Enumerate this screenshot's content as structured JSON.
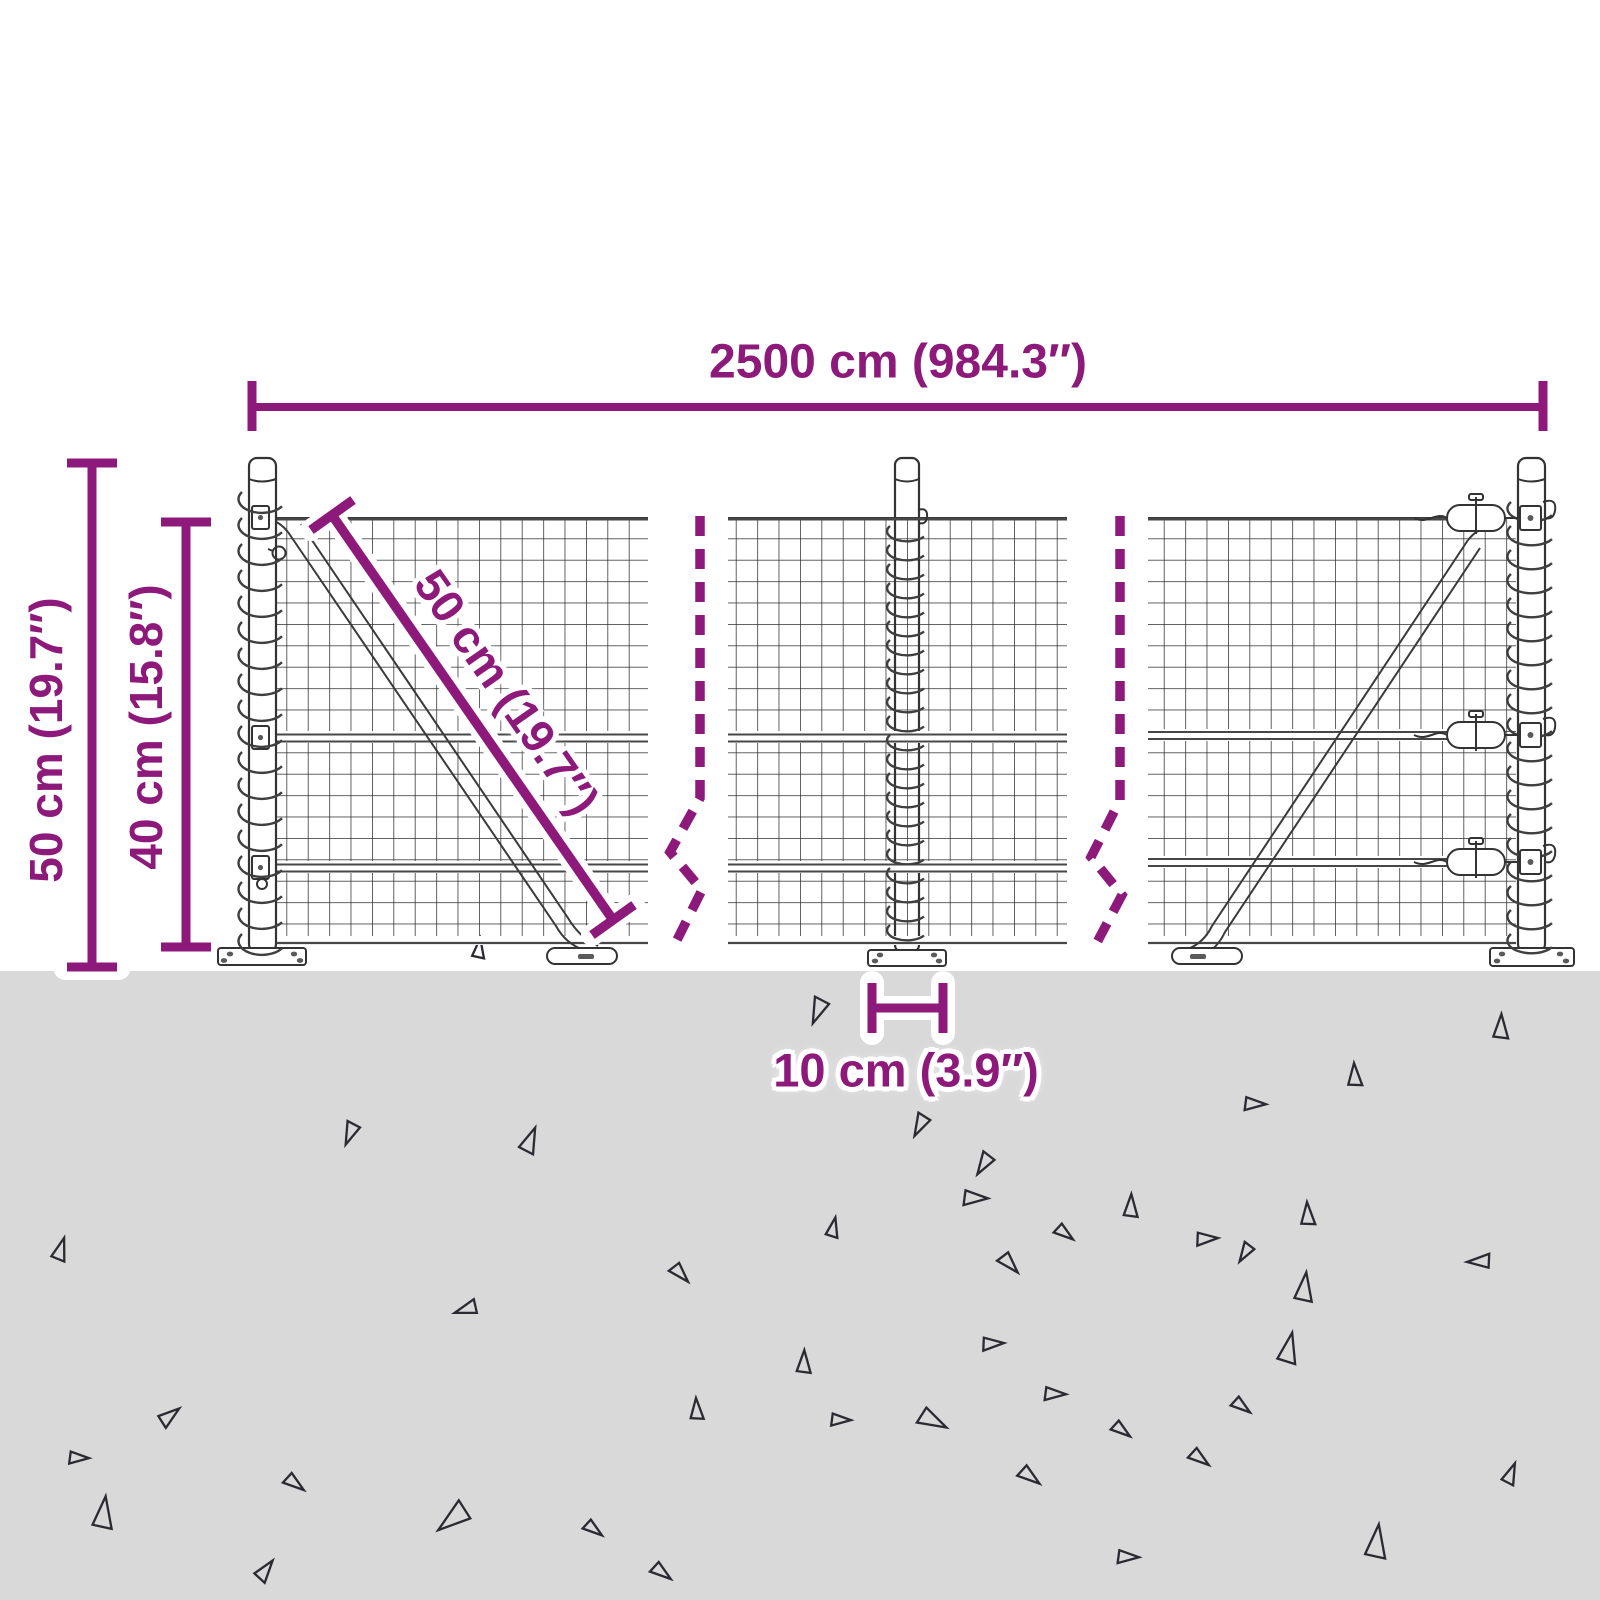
{
  "labels": {
    "width_total": "2500 cm (984.3″)",
    "height_total": "50 cm (19.7″)",
    "mesh_height": "40 cm (15.8″)",
    "mesh_diagonal": "50 cm (19.7″)",
    "post_base": "10 cm (3.9″)"
  },
  "colors": {
    "dimension": "#8d1a7b",
    "ground": "#d9d9d9",
    "debris": "#2a2a32",
    "background": "#ffffff"
  },
  "ground": {
    "triangles": [
      [
        478,
        951,
        13,
        10
      ],
      [
        820,
        1008,
        17,
        205
      ],
      [
        352,
        1131,
        15,
        205
      ],
      [
        528,
        1143,
        17,
        25
      ],
      [
        1500,
        1030,
        16,
        5
      ],
      [
        1354,
        1078,
        15,
        0
      ],
      [
        1252,
        1103,
        14,
        95
      ],
      [
        922,
        1123,
        15,
        210
      ],
      [
        986,
        1162,
        15,
        215
      ],
      [
        59,
        1252,
        15,
        20
      ],
      [
        679,
        1271,
        14,
        140
      ],
      [
        469,
        1309,
        15,
        255
      ],
      [
        972,
        1197,
        16,
        95
      ],
      [
        1130,
        1209,
        15,
        5
      ],
      [
        1063,
        1231,
        13,
        130
      ],
      [
        832,
        1230,
        13,
        15
      ],
      [
        1247,
        1251,
        13,
        215
      ],
      [
        1008,
        1261,
        15,
        140
      ],
      [
        1307,
        1217,
        15,
        0
      ],
      [
        1204,
        1238,
        14,
        90
      ],
      [
        1482,
        1262,
        15,
        270
      ],
      [
        1303,
        1291,
        19,
        10
      ],
      [
        696,
        1412,
        14,
        0
      ],
      [
        293,
        1481,
        14,
        130
      ],
      [
        102,
        1517,
        21,
        10
      ],
      [
        457,
        1517,
        23,
        235
      ],
      [
        592,
        1527,
        13,
        130
      ],
      [
        990,
        1343,
        14,
        90
      ],
      [
        803,
        1365,
        15,
        5
      ],
      [
        1287,
        1352,
        20,
        15
      ],
      [
        1052,
        1393,
        14,
        95
      ],
      [
        1240,
        1404,
        13,
        130
      ],
      [
        838,
        1419,
        13,
        95
      ],
      [
        930,
        1418,
        19,
        120
      ],
      [
        1120,
        1428,
        13,
        130
      ],
      [
        1198,
        1456,
        14,
        130
      ],
      [
        1028,
        1474,
        15,
        130
      ],
      [
        263,
        1572,
        15,
        40
      ],
      [
        660,
        1570,
        14,
        130
      ],
      [
        1125,
        1556,
        14,
        95
      ],
      [
        1375,
        1546,
        22,
        10
      ],
      [
        1509,
        1476,
        14,
        25
      ],
      [
        167,
        1417,
        15,
        55
      ],
      [
        76,
        1457,
        13,
        95
      ]
    ]
  }
}
